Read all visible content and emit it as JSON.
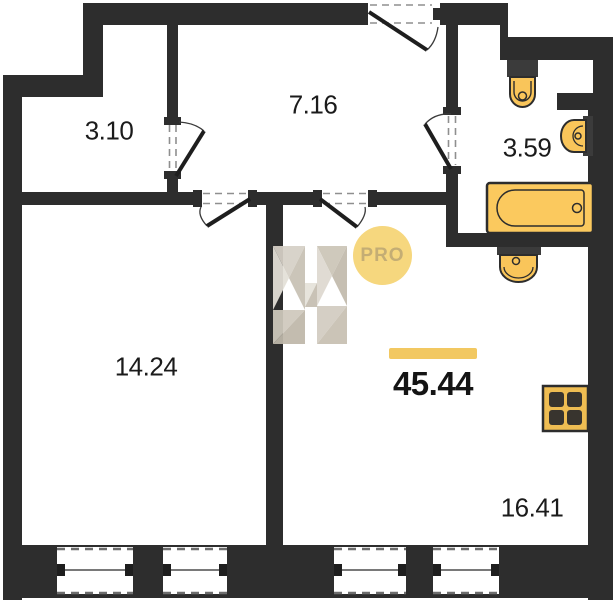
{
  "plan": {
    "total_area": "45.44",
    "badge_label": "PRO",
    "rooms": [
      {
        "name": "storage",
        "area": "3.10"
      },
      {
        "name": "hallway",
        "area": "7.16"
      },
      {
        "name": "bathroom",
        "area": "3.59"
      },
      {
        "name": "bedroom",
        "area": "14.24"
      },
      {
        "name": "living-kitchen",
        "area": "16.41"
      }
    ],
    "fixture_icons": [
      "toilet-icon",
      "washbasin-icon",
      "bathtub-icon",
      "sink-icon",
      "stove-icon"
    ],
    "colors": {
      "wall": "#2d2d2d",
      "fixture_fill": "#F9C55A",
      "stove_fill": "#EFBD52",
      "accent_bar": "#F2C861",
      "badge_bg": "#F6D77E",
      "badge_text": "#C4AD74"
    }
  }
}
